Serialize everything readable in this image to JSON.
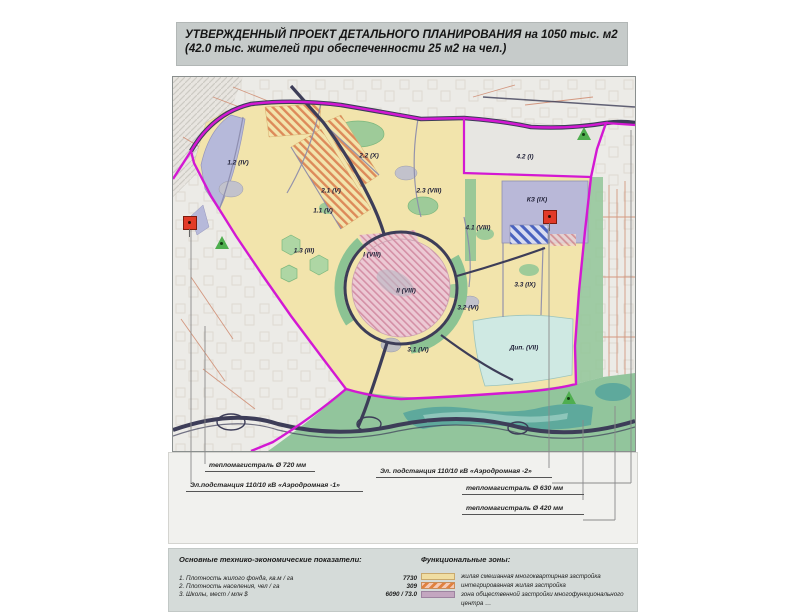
{
  "title": {
    "line1": "УТВЕРЖДЕННЫЙ ПРОЕКТ ДЕТАЛЬНОГО ПЛАНИРОВАНИЯ на 1050 тыс. м2",
    "line2": "(42.0 тыс. жителей при обеспеченности 25 м2 на чел.)"
  },
  "map": {
    "zones": [
      {
        "label": "1.2 (IV)",
        "x": 65,
        "y": 86
      },
      {
        "label": "2.2 (X)",
        "x": 196,
        "y": 79
      },
      {
        "label": "2.1 (V)",
        "x": 158,
        "y": 114
      },
      {
        "label": "1.1 (V)",
        "x": 150,
        "y": 134
      },
      {
        "label": "2.3 (VIII)",
        "x": 256,
        "y": 114
      },
      {
        "label": "1.3 (III)",
        "x": 131,
        "y": 174
      },
      {
        "label": "I (VIII)",
        "x": 199,
        "y": 178
      },
      {
        "label": "II (VIII)",
        "x": 233,
        "y": 214
      },
      {
        "label": "4.2 (I)",
        "x": 352,
        "y": 80
      },
      {
        "label": "КЗ (IX)",
        "x": 364,
        "y": 123
      },
      {
        "label": "4.1 (VIII)",
        "x": 305,
        "y": 151
      },
      {
        "label": "3.3 (IX)",
        "x": 352,
        "y": 208
      },
      {
        "label": "3.2 (VI)",
        "x": 295,
        "y": 231
      },
      {
        "label": "3.1 (VI)",
        "x": 245,
        "y": 273
      },
      {
        "label": "Дип. (VII)",
        "x": 351,
        "y": 271
      }
    ],
    "markers": [
      {
        "type": "red-flag",
        "x": 17,
        "y": 146
      },
      {
        "type": "green-flag",
        "x": 49,
        "y": 166
      },
      {
        "type": "red-flag",
        "x": 377,
        "y": 140
      },
      {
        "type": "green-flag",
        "x": 411,
        "y": 57
      },
      {
        "type": "green-flag",
        "x": 396,
        "y": 321
      }
    ],
    "colors": {
      "boundary": "#d318d3",
      "residential_fill": "#f2e4ac",
      "park_fill": "#9ecb99",
      "public_fill": "#b9b8d8",
      "special_fill": "#cfe9e3",
      "road": "#3d3d58"
    }
  },
  "annotations": {
    "items": [
      {
        "text": "тепломагистраль Ø 720 мм"
      },
      {
        "text": "Эл. подстанция 110/10 кВ «Аэродромная -2»"
      },
      {
        "text": "Эл.подстанция 110/10 кВ «Аэродромная -1»"
      },
      {
        "text": "тепломагистраль Ø 630 мм"
      },
      {
        "text": "тепломагистраль Ø 420 мм"
      }
    ]
  },
  "indicators": {
    "header": "Основные технико-экономические показатели:",
    "rows": [
      {
        "label": "1. Плотность жилого фонда, кв.м / га",
        "value": "7730"
      },
      {
        "label": "2. Плотность населения, чел / га",
        "value": "309"
      },
      {
        "label": "3. Школы, мест / млн $",
        "value": "6090 / 73.0"
      }
    ]
  },
  "legend": {
    "header": "Функциональные зоны:",
    "items": [
      {
        "swatch": "yellow",
        "label": "жилая смешанная многоквартирная застройка"
      },
      {
        "swatch": "hatched",
        "label": "интегрированная жилая застройка"
      },
      {
        "swatch": "purple",
        "label": "зона общественной застройки многофункционального"
      },
      {
        "swatch": "none",
        "label": "центра …"
      }
    ]
  }
}
